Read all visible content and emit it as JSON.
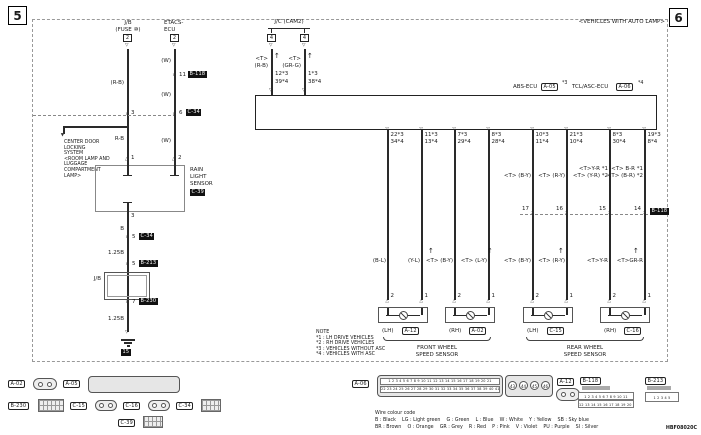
{
  "icons": {
    "junction": "×",
    "term_down": "▽",
    "term_up": "△",
    "arrow_up": "↑",
    "arrow_down": "▼"
  },
  "page": {
    "num_left": "5",
    "num_right": "6",
    "auto_lamp_note": "<VEHICLES WITH AUTO LAMP>",
    "doc_code": "HBF08020C"
  },
  "jb": {
    "title": "J/B",
    "subtitle": "(FUSE ⑩)",
    "conn": "2",
    "wire1": "(R-B)",
    "junction": "3",
    "wire2": "R-B",
    "branch_lines": [
      "CENTER DOOR",
      "LOCKING",
      "SYSTEM",
      "<ROOM LAMP AND",
      "LUGGAGE",
      "COMPARTMENT",
      "LAMP>"
    ]
  },
  "etacs": {
    "title1": "ETACS-",
    "title2": "ECU",
    "conn": "2",
    "wire": "(W)",
    "j1_pin": "11",
    "j1_conn": "B-118",
    "j2_pin": "6",
    "j2_conn": "C-34"
  },
  "rain_sensor": {
    "pin1": "1",
    "pin2": "2",
    "pin3": "3",
    "name": [
      "RAIN",
      "LIGHT",
      "SENSOR"
    ],
    "conn": "C-39",
    "wire_b": "B",
    "j_c34_pin": "5",
    "j_c34": "C-34",
    "wire_125b": "1.25B",
    "j_b213_pin": "5",
    "j_b213": "B-213",
    "jb_label": "J/B",
    "j_b230_pin": "7",
    "j_b230": "B-230",
    "wire_125b2": "1.25B",
    "ground": "15"
  },
  "jc": {
    "title": "J/C (CAM2)",
    "conn_l": "4",
    "conn_r": "4",
    "t_l": "<T>",
    "color_l": "(R-B)",
    "pins_l": [
      "12*3",
      "39*4"
    ],
    "t_r": "<T>",
    "color_r": "(GR-G)",
    "pins_r": [
      "1*3",
      "38*4"
    ]
  },
  "ecu": {
    "abs": "ABS-ECU",
    "abs_conn": "A-05",
    "abs_mark": "*3",
    "tcl": "TCL/ASC-ECU",
    "tcl_conn": "A-06",
    "tcl_mark": "*4"
  },
  "wires": [
    {
      "pin_a": "22*3",
      "pin_b": "34*4",
      "upper": [],
      "lower": "(B-L)",
      "sensor_pin": "2"
    },
    {
      "pin_a": "11*3",
      "pin_b": "13*4",
      "upper": [],
      "lower": "(Y-L)",
      "sensor_pin": "1"
    },
    {
      "pin_a": "7*3",
      "pin_b": "29*4",
      "upper": [],
      "lower": "<T> (B-Y)",
      "sensor_pin": "2"
    },
    {
      "pin_a": "8*3",
      "pin_b": "28*4",
      "upper": [],
      "lower": "<T> (L-Y)",
      "sensor_pin": "1"
    },
    {
      "pin_a": "10*3",
      "pin_b": "11*4",
      "upper": [
        "<T> (B-Y)"
      ],
      "junction": "17",
      "lower": "<T> (B-Y)",
      "sensor_pin": "2"
    },
    {
      "pin_a": "21*3",
      "pin_b": "10*4",
      "upper": [
        "<T> (R-Y)"
      ],
      "junction": "16",
      "lower": "<T> (R-Y)",
      "sensor_pin": "1"
    },
    {
      "pin_a": "8*3",
      "pin_b": "30*4",
      "upper": [
        "<T>Y-R *1",
        "<T> (Y-R) *2"
      ],
      "junction": "15",
      "lower": "<T>Y-R",
      "sensor_pin": "2"
    },
    {
      "pin_a": "19*3",
      "pin_b": "8*4",
      "upper": [
        "<T> B-R *1",
        "<T> (B-R) *2"
      ],
      "junction": "14",
      "junction_conn": "B-118",
      "lower": "<T>GR-R",
      "sensor_pin": "1"
    }
  ],
  "sensors": [
    {
      "side": "(LH)",
      "conn": "A-12"
    },
    {
      "side": "(RH)",
      "conn": "A-02"
    },
    {
      "side": "(LH)",
      "conn": "C-15"
    },
    {
      "side": "(RH)",
      "conn": "C-16"
    }
  ],
  "groups": {
    "front": [
      "FRONT WHEEL",
      "SPEED SENSOR"
    ],
    "rear": [
      "REAR WHEEL",
      "SPEED SENSOR"
    ]
  },
  "note": {
    "title": "NOTE",
    "items": [
      "*1 : LH DRIVE VEHICLES",
      "*2 : RH DRIVE VEHICLES",
      "*3 : VEHICLES WITHOUT ASC",
      "*4 : VEHICLES WITH ASC"
    ]
  },
  "bottom": {
    "legend_title": "Wire colour code",
    "legend_line1": "B : Black    LG : Light green    G : Green    L : Blue    W : White    Y : Yellow    SB : Sky blue",
    "legend_line2": "BR : Brown    O : Orange    GR : Grey    R : Red    P : Pink    V : Violet    PU : Purple    SI : Silver",
    "connectors": {
      "a02": "A-02",
      "a05": "A-05",
      "b230": "B-230",
      "c15": "C-15",
      "c16": "C-16",
      "c34": "C-34",
      "c39": "C-39",
      "a06": "A-06",
      "a06_row1": "1 2 3 4 5 6 7 8 9 10 11 12 13 14 15 16 17 18 19 20 21",
      "a06_row2": "22 23 24 25 26 27 28 29 30 31 32 33 34 35 36 37 38 39 40 41 42",
      "a06_extra": [
        "43",
        "44",
        "45",
        "46"
      ],
      "a12": "A-12",
      "b118": "B-118",
      "b118_row1": "1 2 3 4 5 6 7 8 9 10 11",
      "b118_row2": "12 13 14 15 16 17 18 19 20 21 22",
      "b213": "B-213",
      "b213_row": "1 2 3 4 5"
    }
  }
}
